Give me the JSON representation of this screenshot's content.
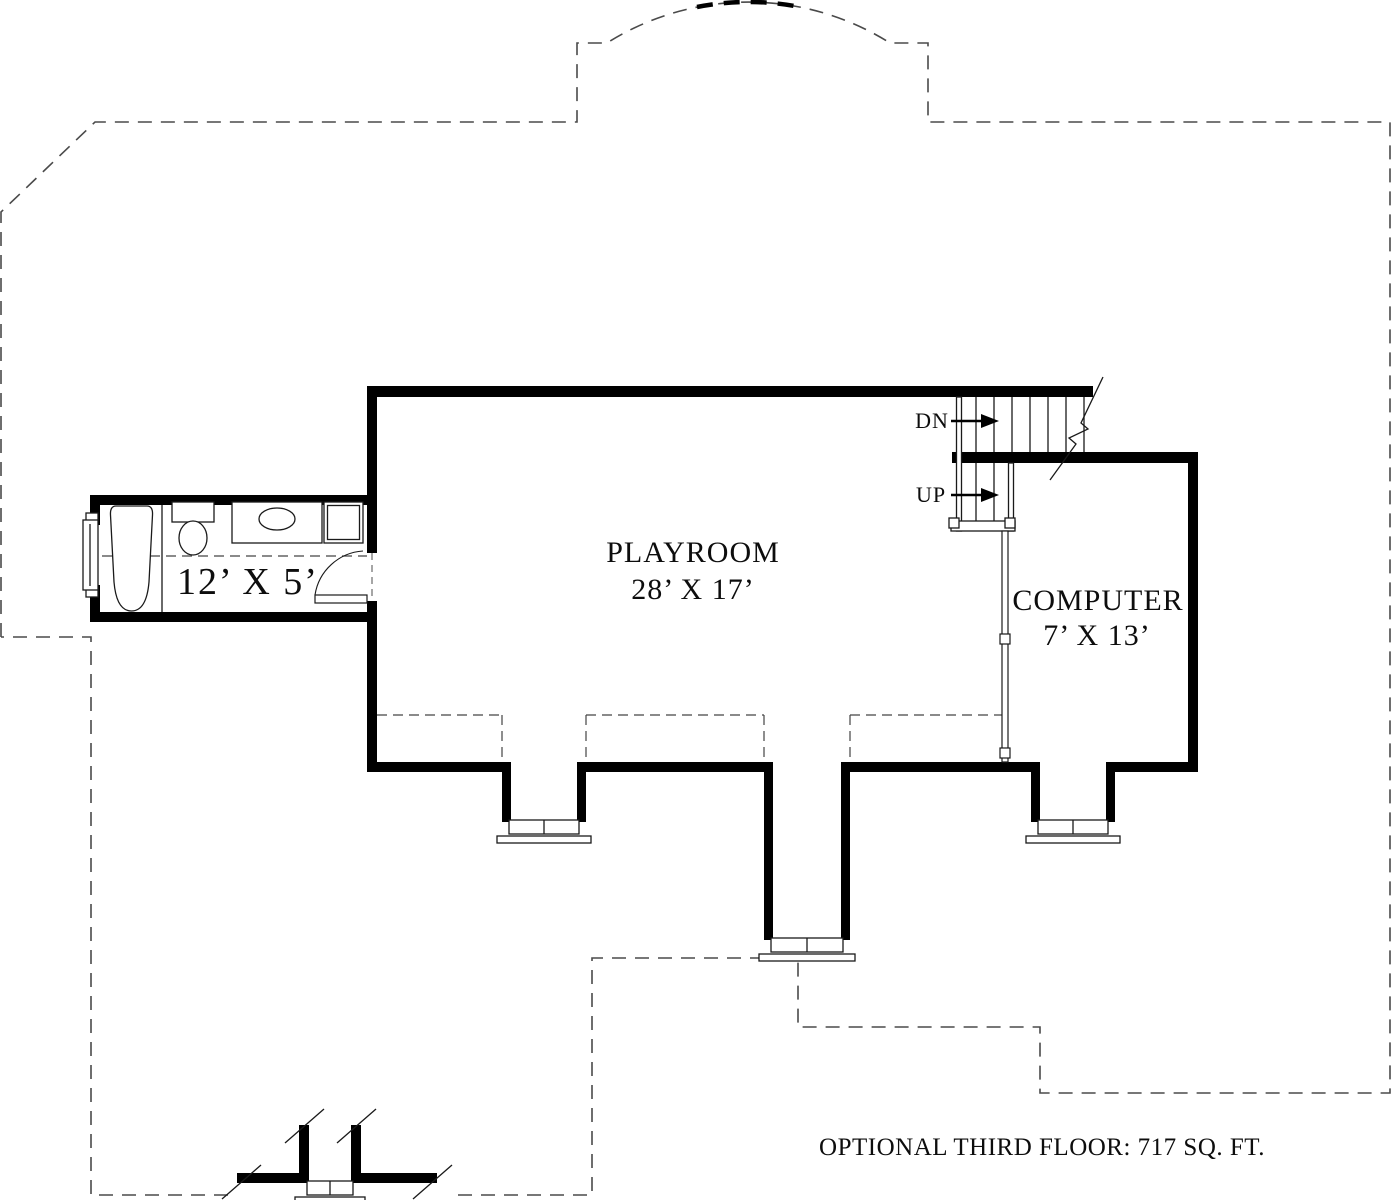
{
  "plan_title": "OPTIONAL THIRD FLOOR: 717 SQ. FT.",
  "rooms": {
    "playroom": {
      "name": "PLAYROOM",
      "dimensions": "28’ X 17’"
    },
    "computer": {
      "name": "COMPUTER",
      "dimensions": "7’ X 13’"
    },
    "bathroom": {
      "dimensions": "12’ X 5’"
    }
  },
  "stairs": {
    "down_label": "DN",
    "up_label": "UP"
  },
  "colors": {
    "wall": "#000000",
    "dashed_outline": "#4a4a4a",
    "thin_line": "#1a1a1a"
  }
}
